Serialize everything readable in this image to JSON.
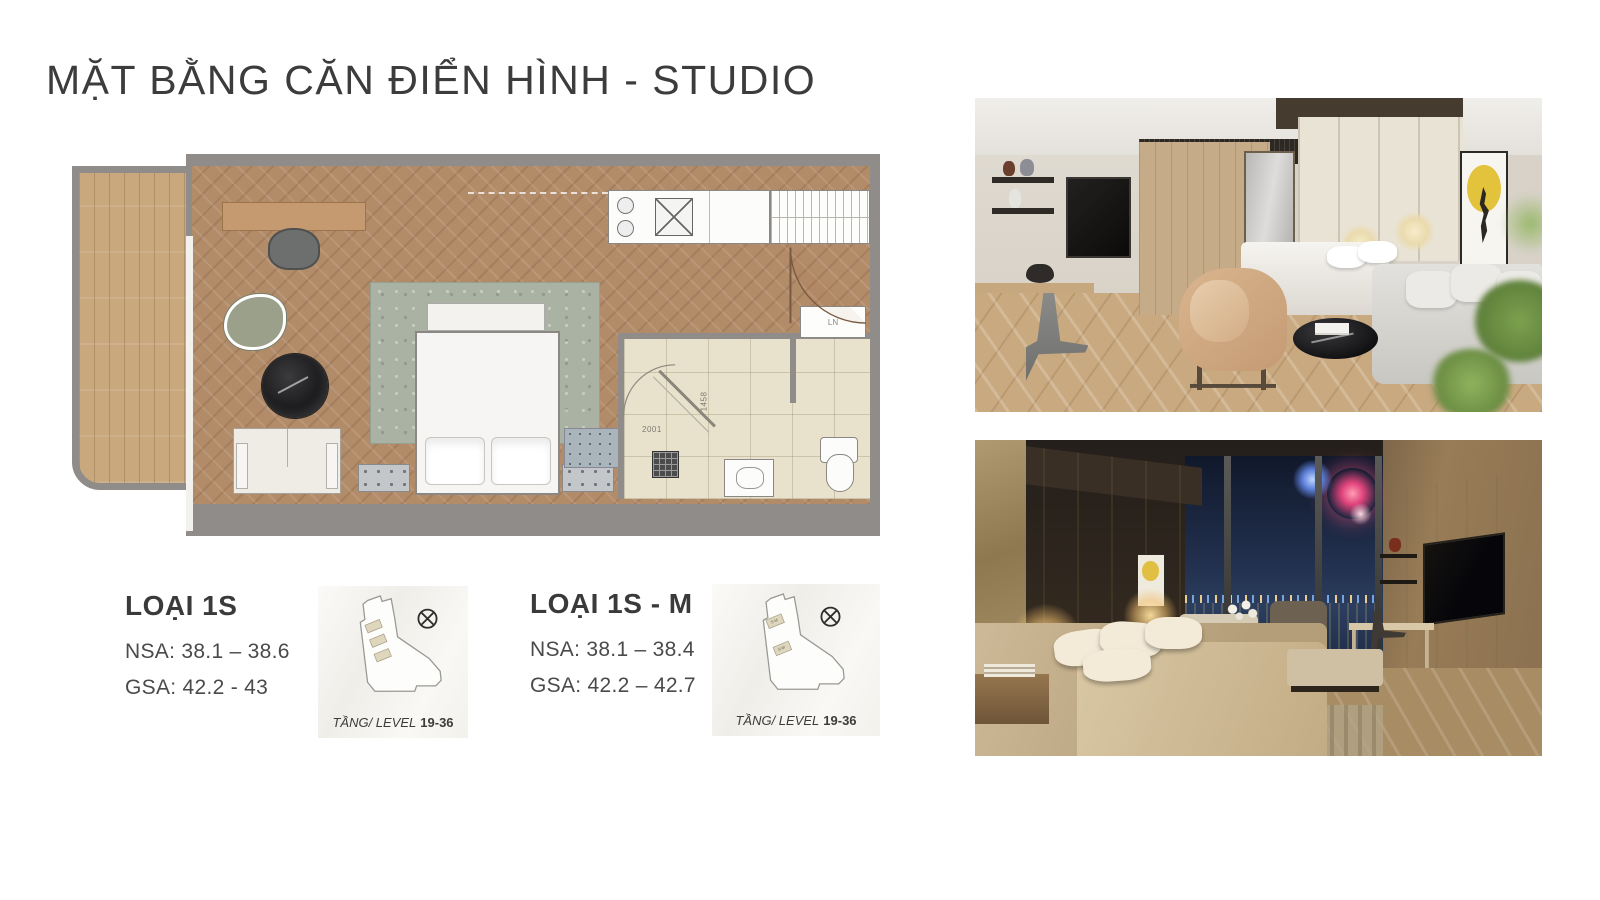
{
  "page": {
    "title": "MẶT BẰNG CĂN ĐIỂN HÌNH - STUDIO"
  },
  "floorplan": {
    "dim_width_label": "2001",
    "dim_height_label": "1458",
    "washer_label": "LN"
  },
  "units": [
    {
      "name": "LOẠI 1S",
      "nsa": "NSA: 38.1 – 38.6",
      "gsa": "GSA: 42.2 - 43",
      "keyplan": {
        "caption": "TẦNG/ LEVEL",
        "levels": "19-36"
      }
    },
    {
      "name": "LOẠI 1S - M",
      "nsa": "NSA: 38.1 – 38.4",
      "gsa": "GSA: 42.2 – 42.7",
      "keyplan": {
        "caption": "TẦNG/ LEVEL",
        "levels": "19-36",
        "unit_marker_label": "S-M"
      }
    }
  ],
  "colors": {
    "title_text": "#3c3c3c",
    "body_text": "#4a4a4a",
    "wall_gray": "#8f8c89",
    "floor_wood": "#b28b69",
    "balcony_wood": "#c9a87e",
    "bath_tile": "#e8e1cc",
    "rug_sage": "#a9b2a3",
    "keyplan_unit_fill": "#ded6bd",
    "art_moon_yellow": "#e3c23c"
  }
}
